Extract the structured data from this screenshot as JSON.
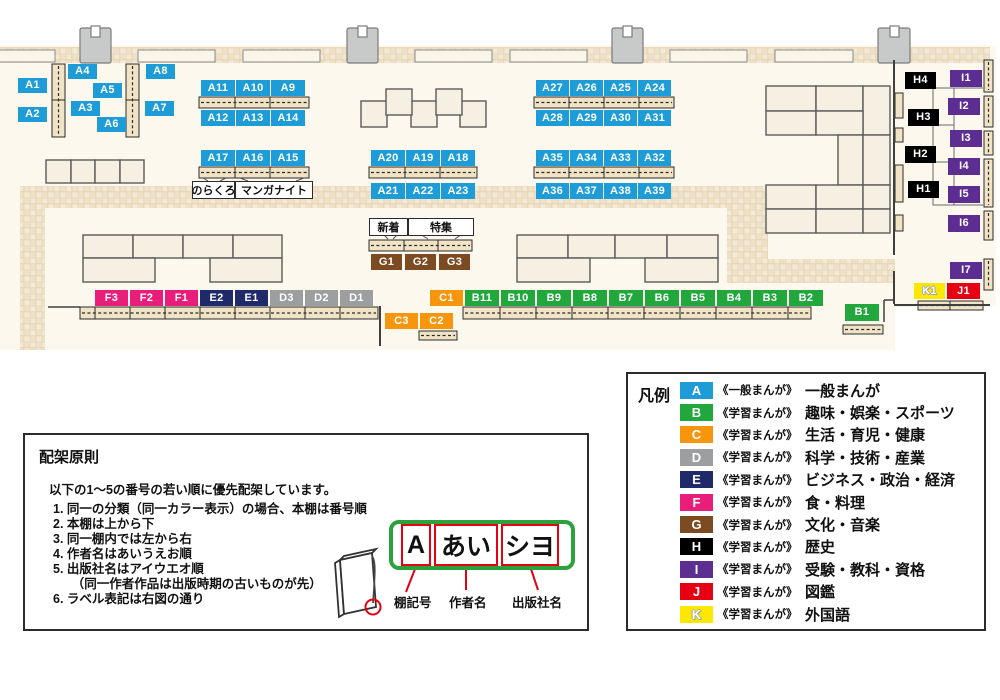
{
  "map": {
    "category_colors": {
      "A": "#1e9cd8",
      "B": "#22a73d",
      "C": "#f7950d",
      "D": "#9d9ea0",
      "E": "#1e2a69",
      "F": "#e91e7b",
      "G": "#7c4b22",
      "H": "#000000",
      "I": "#5c2e91",
      "J": "#e50013",
      "K": "#ffe800"
    },
    "labels": [
      [
        "A1",
        18,
        78,
        29,
        15
      ],
      [
        "A2",
        18,
        107,
        29,
        15
      ],
      [
        "A4",
        68,
        64,
        29,
        15
      ],
      [
        "A3",
        71,
        101,
        29,
        15
      ],
      [
        "A5",
        93,
        83,
        29,
        15
      ],
      [
        "A6",
        97,
        117,
        29,
        15
      ],
      [
        "A8",
        146,
        64,
        29,
        15
      ],
      [
        "A7",
        145,
        101,
        29,
        15
      ],
      [
        "A11",
        201,
        80,
        34,
        16
      ],
      [
        "A10",
        236,
        80,
        34,
        16
      ],
      [
        "A9",
        271,
        80,
        34,
        16
      ],
      [
        "A12",
        201,
        110,
        34,
        16
      ],
      [
        "A13",
        236,
        110,
        34,
        16
      ],
      [
        "A14",
        271,
        110,
        34,
        16
      ],
      [
        "A17",
        201,
        150,
        34,
        16
      ],
      [
        "A16",
        236,
        150,
        34,
        16
      ],
      [
        "A15",
        271,
        150,
        34,
        16
      ],
      [
        "A20",
        371,
        150,
        34,
        16
      ],
      [
        "A19",
        406,
        150,
        34,
        16
      ],
      [
        "A18",
        441,
        150,
        34,
        16
      ],
      [
        "A21",
        371,
        183,
        34,
        16
      ],
      [
        "A22",
        406,
        183,
        34,
        16
      ],
      [
        "A23",
        441,
        183,
        34,
        16
      ],
      [
        "A27",
        536,
        80,
        33,
        16
      ],
      [
        "A26",
        570,
        80,
        33,
        16
      ],
      [
        "A25",
        604,
        80,
        33,
        16
      ],
      [
        "A24",
        638,
        80,
        33,
        16
      ],
      [
        "A28",
        536,
        110,
        33,
        16
      ],
      [
        "A29",
        570,
        110,
        33,
        16
      ],
      [
        "A30",
        604,
        110,
        33,
        16
      ],
      [
        "A31",
        638,
        110,
        33,
        16
      ],
      [
        "A35",
        536,
        150,
        33,
        16
      ],
      [
        "A34",
        570,
        150,
        33,
        16
      ],
      [
        "A33",
        604,
        150,
        33,
        16
      ],
      [
        "A32",
        638,
        150,
        33,
        16
      ],
      [
        "A36",
        536,
        183,
        33,
        16
      ],
      [
        "A37",
        570,
        183,
        33,
        16
      ],
      [
        "A38",
        604,
        183,
        33,
        16
      ],
      [
        "A39",
        638,
        183,
        33,
        16
      ],
      [
        "G1",
        371,
        254,
        31,
        16
      ],
      [
        "G2",
        405,
        254,
        31,
        16
      ],
      [
        "G3",
        439,
        254,
        31,
        16
      ],
      [
        "F3",
        95,
        290,
        33,
        16
      ],
      [
        "F2",
        130,
        290,
        33,
        16
      ],
      [
        "F1",
        165,
        290,
        33,
        16
      ],
      [
        "E2",
        200,
        290,
        33,
        16
      ],
      [
        "E1",
        235,
        290,
        33,
        16
      ],
      [
        "D3",
        270,
        290,
        33,
        16
      ],
      [
        "D2",
        305,
        290,
        33,
        16
      ],
      [
        "D1",
        340,
        290,
        33,
        16
      ],
      [
        "C1",
        430,
        290,
        33,
        16
      ],
      [
        "B11",
        465,
        290,
        34,
        16
      ],
      [
        "B10",
        501,
        290,
        34,
        16
      ],
      [
        "B9",
        537,
        290,
        34,
        16
      ],
      [
        "B8",
        573,
        290,
        34,
        16
      ],
      [
        "B7",
        609,
        290,
        34,
        16
      ],
      [
        "B6",
        645,
        290,
        34,
        16
      ],
      [
        "B5",
        681,
        290,
        34,
        16
      ],
      [
        "B4",
        717,
        290,
        34,
        16
      ],
      [
        "B3",
        753,
        290,
        34,
        16
      ],
      [
        "B2",
        789,
        290,
        34,
        16
      ],
      [
        "C3",
        385,
        313,
        33,
        16
      ],
      [
        "C2",
        420,
        313,
        33,
        16
      ],
      [
        "B1",
        845,
        304,
        34,
        17
      ],
      [
        "K1",
        914,
        283,
        31,
        16
      ],
      [
        "J1",
        947,
        283,
        33,
        16
      ],
      [
        "H4",
        905,
        72,
        31,
        17
      ],
      [
        "H3",
        908,
        109,
        31,
        17
      ],
      [
        "H2",
        905,
        146,
        31,
        17
      ],
      [
        "H1",
        908,
        181,
        31,
        17
      ],
      [
        "I1",
        950,
        70,
        32,
        17
      ],
      [
        "I2",
        948,
        98,
        32,
        17
      ],
      [
        "I3",
        950,
        130,
        32,
        17
      ],
      [
        "I4",
        948,
        158,
        32,
        17
      ],
      [
        "I5",
        948,
        186,
        32,
        17
      ],
      [
        "I6",
        948,
        215,
        32,
        17
      ],
      [
        "I7",
        950,
        262,
        32,
        17
      ]
    ],
    "annotations": {
      "norakuro": "のらくろ",
      "manga_night": "マンガナイト",
      "shinchaku": "新着",
      "tokushu": "特集"
    }
  },
  "legend": {
    "title": "凡例",
    "items": [
      {
        "code": "A",
        "series": "《一般まんが》",
        "name": "一般まんが"
      },
      {
        "code": "B",
        "series": "《学習まんが》",
        "name": "趣味・娯楽・スポーツ"
      },
      {
        "code": "C",
        "series": "《学習まんが》",
        "name": "生活・育児・健康"
      },
      {
        "code": "D",
        "series": "《学習まんが》",
        "name": "科学・技術・産業"
      },
      {
        "code": "E",
        "series": "《学習まんが》",
        "name": "ビジネス・政治・経済"
      },
      {
        "code": "F",
        "series": "《学習まんが》",
        "name": "食・料理"
      },
      {
        "code": "G",
        "series": "《学習まんが》",
        "name": "文化・音楽"
      },
      {
        "code": "H",
        "series": "《学習まんが》",
        "name": "歴史"
      },
      {
        "code": "I",
        "series": "《学習まんが》",
        "name": "受験・教科・資格"
      },
      {
        "code": "J",
        "series": "《学習まんが》",
        "name": "図鑑"
      },
      {
        "code": "K",
        "series": "《学習まんが》",
        "name": "外国語"
      }
    ]
  },
  "principles": {
    "title": "配架原則",
    "intro": "以下の1～5の番号の若い順に優先配架しています。",
    "items": [
      "1. 同一の分類（同一カラー表示）の場合、本棚は番号順",
      "2. 本棚は上から下",
      "3. 同一棚内では左から右",
      "4. 作者名はあいうえお順",
      "5. 出版社名はアイウエオ順",
      "　　（同一作者作品は出版時期の古いものが先）",
      "6. ラベル表記は右図の通り"
    ]
  },
  "label_sample": {
    "shelf_code": "A",
    "author": "あい",
    "publisher": "シヨ",
    "captions": {
      "shelf": "棚記号",
      "author": "作者名",
      "publisher": "出版社名"
    }
  }
}
